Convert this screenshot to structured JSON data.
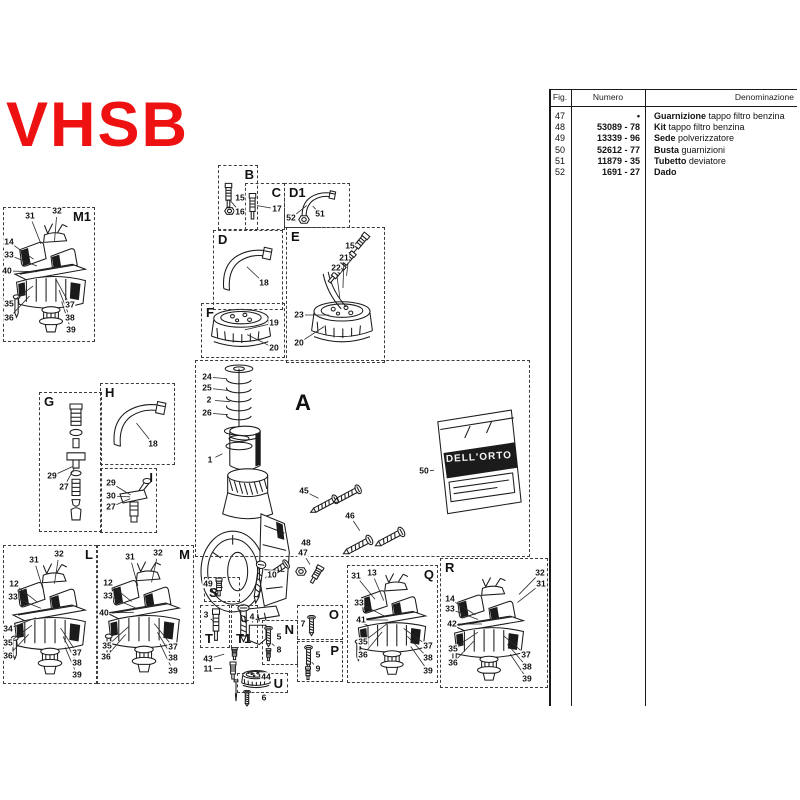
{
  "title": "VHSB",
  "accent_color": "#ee1111",
  "table": {
    "headers": {
      "fig": "Fig.",
      "numero": "Numero",
      "denominazione": "Denominazione"
    },
    "rows": [
      {
        "fig": "47",
        "numero": "•",
        "name": "Guarnizione",
        "desc": "tappo filtro benzina"
      },
      {
        "fig": "48",
        "numero": "53089 - 78",
        "name": "Kit",
        "desc": "tappo filtro benzina"
      },
      {
        "fig": "49",
        "numero": "13339 - 96",
        "name": "Sede",
        "desc": "polverizzatore"
      },
      {
        "fig": "50",
        "numero": "52612 - 77",
        "name": "Busta",
        "desc": "guarnizioni"
      },
      {
        "fig": "51",
        "numero": "11879 - 35",
        "name": "Tubetto",
        "desc": "deviatore"
      },
      {
        "fig": "52",
        "numero": "1691 - 27",
        "name": "Dado",
        "desc": ""
      }
    ]
  },
  "diagram": {
    "packet_brand": "DELL'ORTO",
    "boxes": [
      {
        "label": "M1",
        "lp": "tr",
        "x": 3,
        "y": 207,
        "w": 92,
        "h": 135,
        "anchor": [
          52,
          272
        ],
        "callouts": [
          [
            "31",
            30,
            216
          ],
          [
            "32",
            57,
            211
          ],
          [
            "14",
            9,
            242
          ],
          [
            "33",
            9,
            255
          ],
          [
            "40",
            7,
            271
          ],
          [
            "35",
            9,
            304
          ],
          [
            "36",
            9,
            318
          ],
          [
            "37",
            70,
            305
          ],
          [
            "38",
            70,
            318
          ],
          [
            "39",
            71,
            330
          ]
        ]
      },
      {
        "label": "B",
        "lp": "tr",
        "x": 218,
        "y": 165,
        "w": 40,
        "h": 65,
        "anchor": [
          228,
          198
        ],
        "callouts": [
          [
            "15",
            240,
            198
          ],
          [
            "16",
            240,
            212
          ]
        ]
      },
      {
        "label": "C",
        "lp": "tr",
        "x": 245,
        "y": 183,
        "w": 40,
        "h": 47,
        "anchor": [
          253,
          205
        ],
        "callouts": [
          [
            "17",
            277,
            209
          ]
        ]
      },
      {
        "label": "D1",
        "lp": "tl",
        "x": 284,
        "y": 183,
        "w": 66,
        "h": 45,
        "anchor": [
          310,
          203
        ],
        "callouts": [
          [
            "51",
            320,
            214
          ],
          [
            "52",
            291,
            218
          ]
        ]
      },
      {
        "label": "D",
        "lp": "tl",
        "x": 213,
        "y": 230,
        "w": 70,
        "h": 80,
        "anchor": [
          244,
          264
        ],
        "callouts": [
          [
            "18",
            264,
            283
          ]
        ]
      },
      {
        "label": "E",
        "lp": "tl",
        "x": 286,
        "y": 227,
        "w": 99,
        "h": 136,
        "anchor": [
          342,
          315
        ],
        "callouts": [
          [
            "15",
            350,
            246
          ],
          [
            "21",
            344,
            258
          ],
          [
            "22",
            336,
            268
          ],
          [
            "23",
            299,
            315
          ],
          [
            "20",
            299,
            343
          ]
        ]
      },
      {
        "label": "F",
        "lp": "tl",
        "x": 201,
        "y": 303,
        "w": 84,
        "h": 55,
        "anchor": [
          240,
          331
        ],
        "callouts": [
          [
            "19",
            274,
            323
          ],
          [
            "20",
            274,
            348
          ]
        ]
      },
      {
        "label": "G",
        "lp": "tl",
        "x": 39,
        "y": 392,
        "w": 63,
        "h": 140,
        "anchor": [
          76,
          465
        ],
        "callouts": [
          [
            "29",
            52,
            476
          ],
          [
            "27",
            64,
            487
          ]
        ]
      },
      {
        "label": "H",
        "lp": "tl",
        "x": 100,
        "y": 383,
        "w": 75,
        "h": 82,
        "anchor": [
          134,
          420
        ],
        "callouts": [
          [
            "18",
            153,
            444
          ]
        ]
      },
      {
        "label": "I",
        "lp": "tr",
        "x": 100,
        "y": 468,
        "w": 57,
        "h": 65,
        "anchor": [
          134,
          497
        ],
        "callouts": [
          [
            "29",
            111,
            483
          ],
          [
            "30",
            111,
            496
          ],
          [
            "27",
            111,
            507
          ]
        ]
      },
      {
        "label": "A",
        "lp": "free",
        "big": true,
        "label_xy": [
          303,
          403
        ],
        "x": 195,
        "y": 360,
        "w": 335,
        "h": 197,
        "anchor": [
          260,
          460
        ],
        "callouts": []
      },
      {
        "label": "L",
        "lp": "tr",
        "x": 3,
        "y": 545,
        "w": 94,
        "h": 139,
        "anchor": [
          50,
          612
        ],
        "callouts": [
          [
            "31",
            34,
            560
          ],
          [
            "32",
            59,
            554
          ],
          [
            "12",
            14,
            584
          ],
          [
            "33",
            13,
            597
          ],
          [
            "34",
            8,
            629
          ],
          [
            "35",
            8,
            643
          ],
          [
            "36",
            8,
            656
          ],
          [
            "37",
            77,
            653
          ],
          [
            "38",
            77,
            663
          ],
          [
            "39",
            77,
            675
          ]
        ]
      },
      {
        "label": "M",
        "lp": "tr",
        "x": 97,
        "y": 545,
        "w": 97,
        "h": 139,
        "anchor": [
          145,
          612
        ],
        "callouts": [
          [
            "31",
            130,
            557
          ],
          [
            "32",
            158,
            553
          ],
          [
            "12",
            108,
            583
          ],
          [
            "33",
            108,
            596
          ],
          [
            "40",
            104,
            613
          ],
          [
            "35",
            107,
            646
          ],
          [
            "36",
            106,
            657
          ],
          [
            "37",
            173,
            647
          ],
          [
            "38",
            173,
            658
          ],
          [
            "39",
            173,
            671
          ]
        ]
      },
      {
        "label": "S",
        "lp": "bl",
        "x": 204,
        "y": 577,
        "w": 36,
        "h": 25,
        "anchor": [
          220,
          588
        ],
        "callouts": [
          [
            "49",
            208,
            584
          ]
        ]
      },
      {
        "label": "T",
        "lp": "bl",
        "x": 200,
        "y": 605,
        "w": 30,
        "h": 43,
        "anchor": [
          217,
          624
        ],
        "callouts": [
          [
            "3",
            206,
            615
          ]
        ]
      },
      {
        "label": "T1",
        "lp": "bl",
        "x": 231,
        "y": 605,
        "w": 27,
        "h": 43,
        "anchor": [
          243,
          624
        ],
        "callouts": [
          [
            "4",
            252,
            617
          ]
        ]
      },
      {
        "label": "N",
        "lp": "tr",
        "x": 262,
        "y": 620,
        "w": 36,
        "h": 45,
        "anchor": [
          269,
          641
        ],
        "callouts": [
          [
            "5",
            279,
            637
          ],
          [
            "8",
            279,
            650
          ]
        ]
      },
      {
        "label": "O",
        "lp": "tr",
        "x": 297,
        "y": 605,
        "w": 46,
        "h": 35,
        "anchor": [
          311,
          627
        ],
        "callouts": [
          [
            "7",
            303,
            624
          ]
        ]
      },
      {
        "label": "P",
        "lp": "tr",
        "x": 297,
        "y": 641,
        "w": 46,
        "h": 41,
        "anchor": [
          309,
          659
        ],
        "callouts": [
          [
            "5",
            318,
            655
          ],
          [
            "9",
            318,
            669
          ]
        ]
      },
      {
        "label": "U",
        "lp": "br",
        "x": 237,
        "y": 673,
        "w": 51,
        "h": 20,
        "anchor": [
          256,
          681
        ],
        "callouts": [
          [
            "44",
            266,
            677
          ]
        ]
      },
      {
        "label": "Q",
        "lp": "tr",
        "x": 347,
        "y": 565,
        "w": 91,
        "h": 118,
        "anchor": [
          392,
          620
        ],
        "callouts": [
          [
            "31",
            356,
            576
          ],
          [
            "13",
            372,
            573
          ],
          [
            "33",
            359,
            603
          ],
          [
            "41",
            361,
            620
          ],
          [
            "35",
            363,
            642
          ],
          [
            "36",
            363,
            655
          ],
          [
            "37",
            428,
            646
          ],
          [
            "38",
            428,
            658
          ],
          [
            "39",
            428,
            671
          ]
        ]
      },
      {
        "label": "R",
        "lp": "tl",
        "x": 440,
        "y": 558,
        "w": 108,
        "h": 130,
        "anchor": [
          490,
          624
        ],
        "callouts": [
          [
            "32",
            540,
            573
          ],
          [
            "31",
            541,
            584
          ],
          [
            "14",
            450,
            599
          ],
          [
            "33",
            450,
            609
          ],
          [
            "42",
            452,
            624
          ],
          [
            "35",
            453,
            649
          ],
          [
            "36",
            453,
            663
          ],
          [
            "37",
            526,
            655
          ],
          [
            "38",
            527,
            667
          ],
          [
            "39",
            527,
            679
          ]
        ]
      }
    ],
    "loose_callouts": [
      [
        "24",
        207,
        377,
        230,
        379
      ],
      [
        "25",
        207,
        388,
        232,
        391
      ],
      [
        "2",
        209,
        400,
        234,
        402
      ],
      [
        "26",
        207,
        413,
        232,
        415
      ],
      [
        "1",
        210,
        460,
        226,
        452
      ],
      [
        "45",
        304,
        491,
        322,
        500
      ],
      [
        "46",
        350,
        516,
        362,
        534
      ],
      [
        "48",
        306,
        543,
        298,
        561
      ],
      [
        "47",
        303,
        553,
        312,
        568
      ],
      [
        "10",
        272,
        575,
        261,
        580
      ],
      [
        "50",
        424,
        471,
        438,
        470
      ],
      [
        "43",
        208,
        659,
        228,
        653
      ],
      [
        "11",
        208,
        669,
        226,
        668
      ],
      [
        "6",
        264,
        698,
        253,
        699
      ]
    ],
    "art": [
      [
        "floatbowl",
        10,
        222,
        82,
        114,
        0
      ],
      [
        "floatbowl",
        8,
        562,
        84,
        116,
        0
      ],
      [
        "floatbowl",
        102,
        560,
        84,
        116,
        0
      ],
      [
        "floatbowl",
        352,
        572,
        80,
        106,
        0
      ],
      [
        "floatbowl",
        448,
        576,
        82,
        108,
        0
      ],
      [
        "spring",
        216,
        362,
        46,
        90,
        0
      ],
      [
        "slide",
        225,
        424,
        40,
        52,
        0
      ],
      [
        "carbbody",
        196,
        464,
        100,
        192,
        0
      ],
      [
        "cap",
        206,
        306,
        70,
        48,
        0
      ],
      [
        "cap",
        306,
        298,
        72,
        52,
        0
      ],
      [
        "pipe",
        324,
        270,
        18,
        42,
        -22
      ],
      [
        "jet",
        352,
        230,
        14,
        28,
        40
      ],
      [
        "jet",
        341,
        249,
        12,
        24,
        40
      ],
      [
        "jet",
        329,
        261,
        14,
        26,
        40
      ],
      [
        "tube",
        216,
        240,
        58,
        54,
        0
      ],
      [
        "tube",
        106,
        394,
        62,
        56,
        0
      ],
      [
        "tube",
        297,
        186,
        40,
        36,
        0
      ],
      [
        "nut",
        298,
        215,
        12,
        9,
        0
      ],
      [
        "jet",
        222,
        182,
        13,
        28,
        0
      ],
      [
        "nut",
        224,
        207,
        11,
        8,
        0
      ],
      [
        "jet",
        246,
        192,
        13,
        30,
        0
      ],
      [
        "stack",
        61,
        402,
        30,
        122,
        0
      ],
      [
        "tjet",
        116,
        476,
        40,
        50,
        0
      ],
      [
        "screwlong",
        318,
        489,
        11,
        33,
        62
      ],
      [
        "screwlong",
        341,
        479,
        11,
        33,
        62
      ],
      [
        "screwlong",
        351,
        529,
        12,
        35,
        62
      ],
      [
        "screwlong",
        383,
        521,
        12,
        35,
        62
      ],
      [
        "screwlong",
        271,
        556,
        11,
        29,
        56
      ],
      [
        "nut",
        295,
        567,
        12,
        9,
        0
      ],
      [
        "jet",
        309,
        564,
        14,
        22,
        30
      ],
      [
        "screwlong",
        253,
        560,
        11,
        46,
        8
      ],
      [
        "packet",
        432,
        408,
        90,
        108,
        -3
      ],
      [
        "jet",
        213,
        577,
        12,
        21,
        0
      ],
      [
        "jet",
        209,
        607,
        14,
        37,
        0
      ],
      [
        "screwlong",
        237,
        604,
        13,
        40,
        0
      ],
      [
        "screwlong",
        264,
        626,
        9,
        22,
        0
      ],
      [
        "jet",
        264,
        648,
        9,
        14,
        0
      ],
      [
        "screwlong",
        307,
        615,
        9,
        22,
        0
      ],
      [
        "screwlong",
        304,
        645,
        9,
        24,
        0
      ],
      [
        "jet",
        303,
        666,
        10,
        15,
        0
      ],
      [
        "cap",
        239,
        669,
        34,
        22,
        0
      ],
      [
        "screwlong",
        243,
        690,
        8,
        17,
        0
      ],
      [
        "jet",
        229,
        647,
        11,
        14,
        0
      ],
      [
        "jet",
        227,
        661,
        12,
        20,
        0
      ],
      [
        "needle",
        231,
        679,
        10,
        24,
        0
      ]
    ]
  }
}
